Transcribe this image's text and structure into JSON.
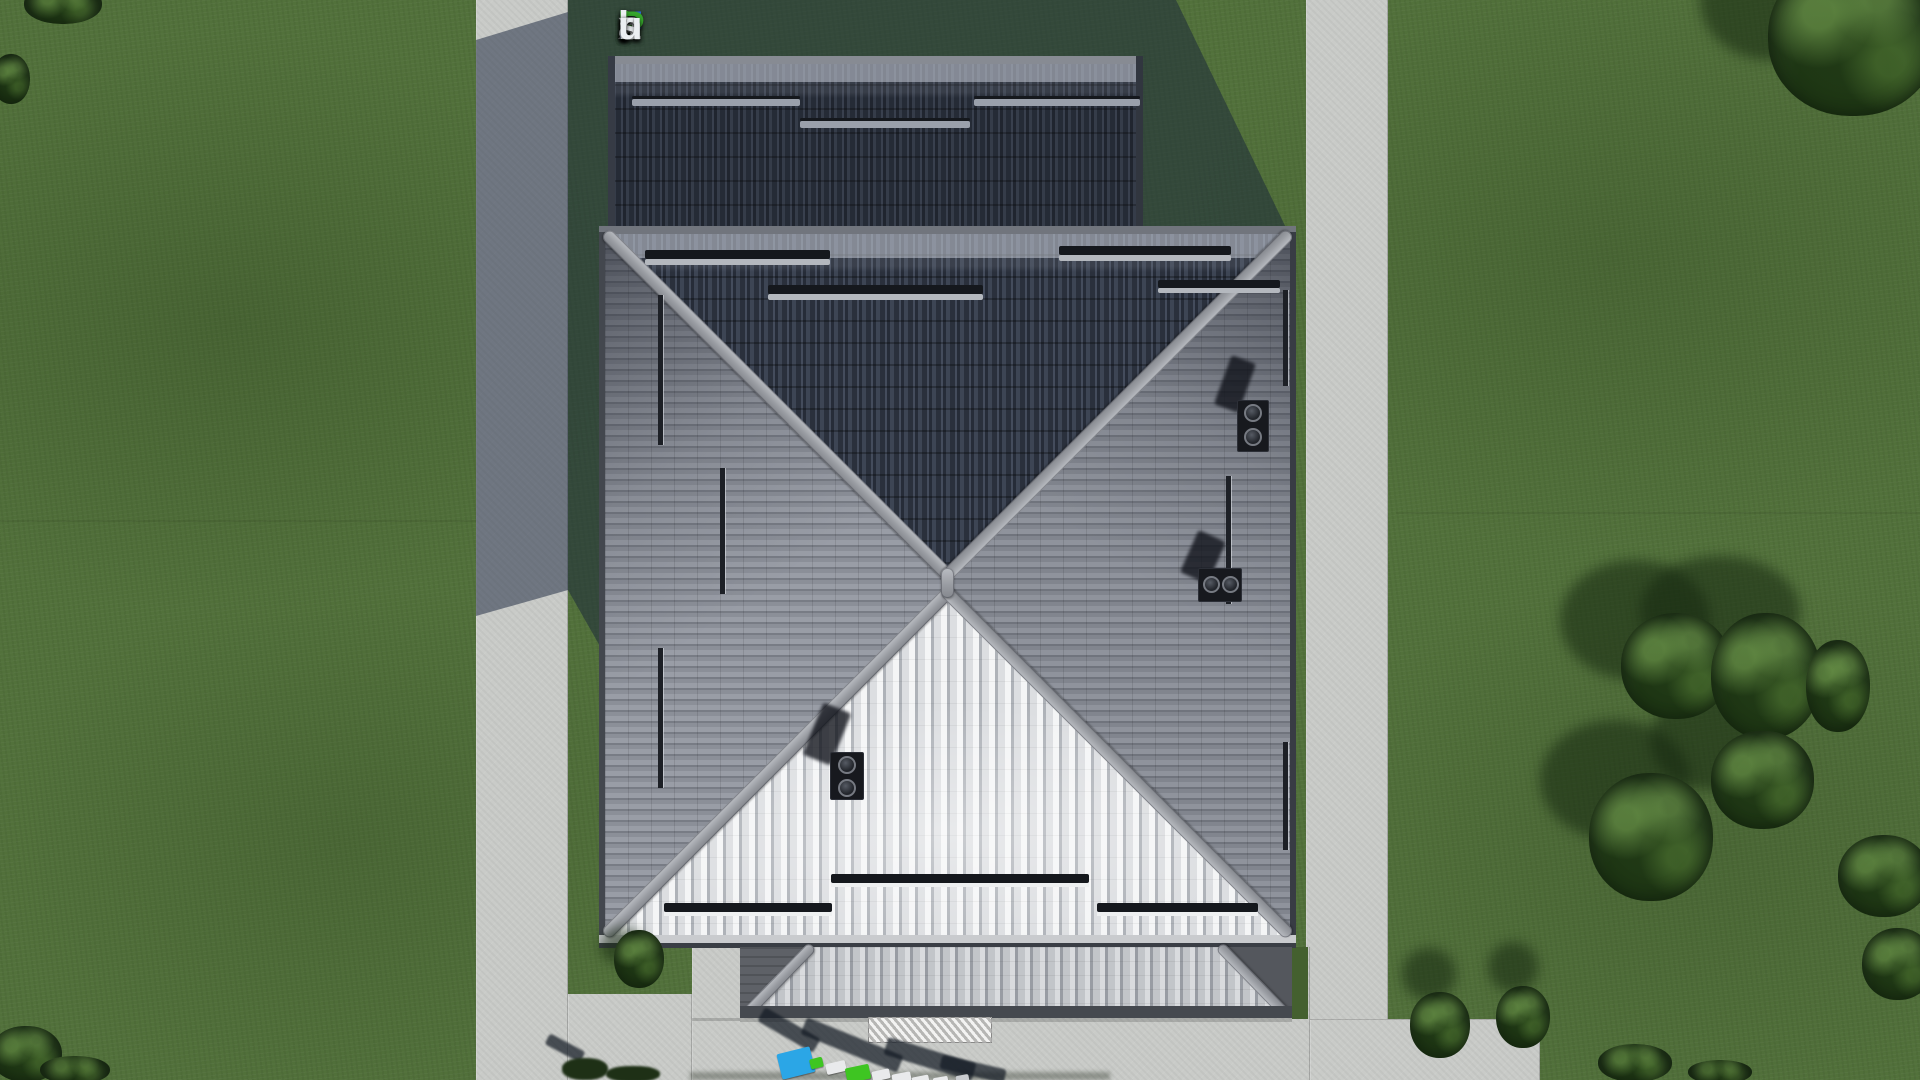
{
  "scene": {
    "title": "Aerial top-down 3D architectural render of a house with a gray hipped tile roof, garage roof, porch roof, concrete walkways and lawn",
    "watermark_top": {
      "text": "FixPlans.ru",
      "chars": [
        {
          "ch": "F",
          "color": "#2b6be0"
        },
        {
          "ch": "i",
          "color": "#eceff2",
          "dot": "#36a42c"
        },
        {
          "ch": "x",
          "color": "#eceff2"
        },
        {
          "ch": "P",
          "color": "#36a42c"
        },
        {
          "ch": "l",
          "color": "#eceff2"
        },
        {
          "ch": "a",
          "color": "#eceff2"
        },
        {
          "ch": "n",
          "color": "#eceff2"
        },
        {
          "ch": "s",
          "color": "#eceff2"
        },
        {
          "ch": ".",
          "color": "#2b6be0"
        },
        {
          "ch": "r",
          "color": "#eceff2"
        },
        {
          "ch": "u",
          "color": "#eceff2"
        }
      ]
    },
    "watermark_bottom": {
      "text": "FixPlans.ru",
      "note": "3D standing letters on the driveway, cut off at the bottom edge of the image"
    }
  },
  "colors": {
    "grass": "#52713b",
    "grass-dark": "#44602f",
    "path": "#c9cbc8",
    "shadow": "rgba(22,34,58,0.50)",
    "roof-dark": "#2b313d",
    "roof-mid": "#83878f",
    "roof-bright": "#dfe1e3",
    "ridge": "#a4a7ad",
    "fascia": "#43474e",
    "foliage": "#22371a",
    "plate-blue": "#2ba6e6",
    "plate-green": "#3ec522"
  }
}
